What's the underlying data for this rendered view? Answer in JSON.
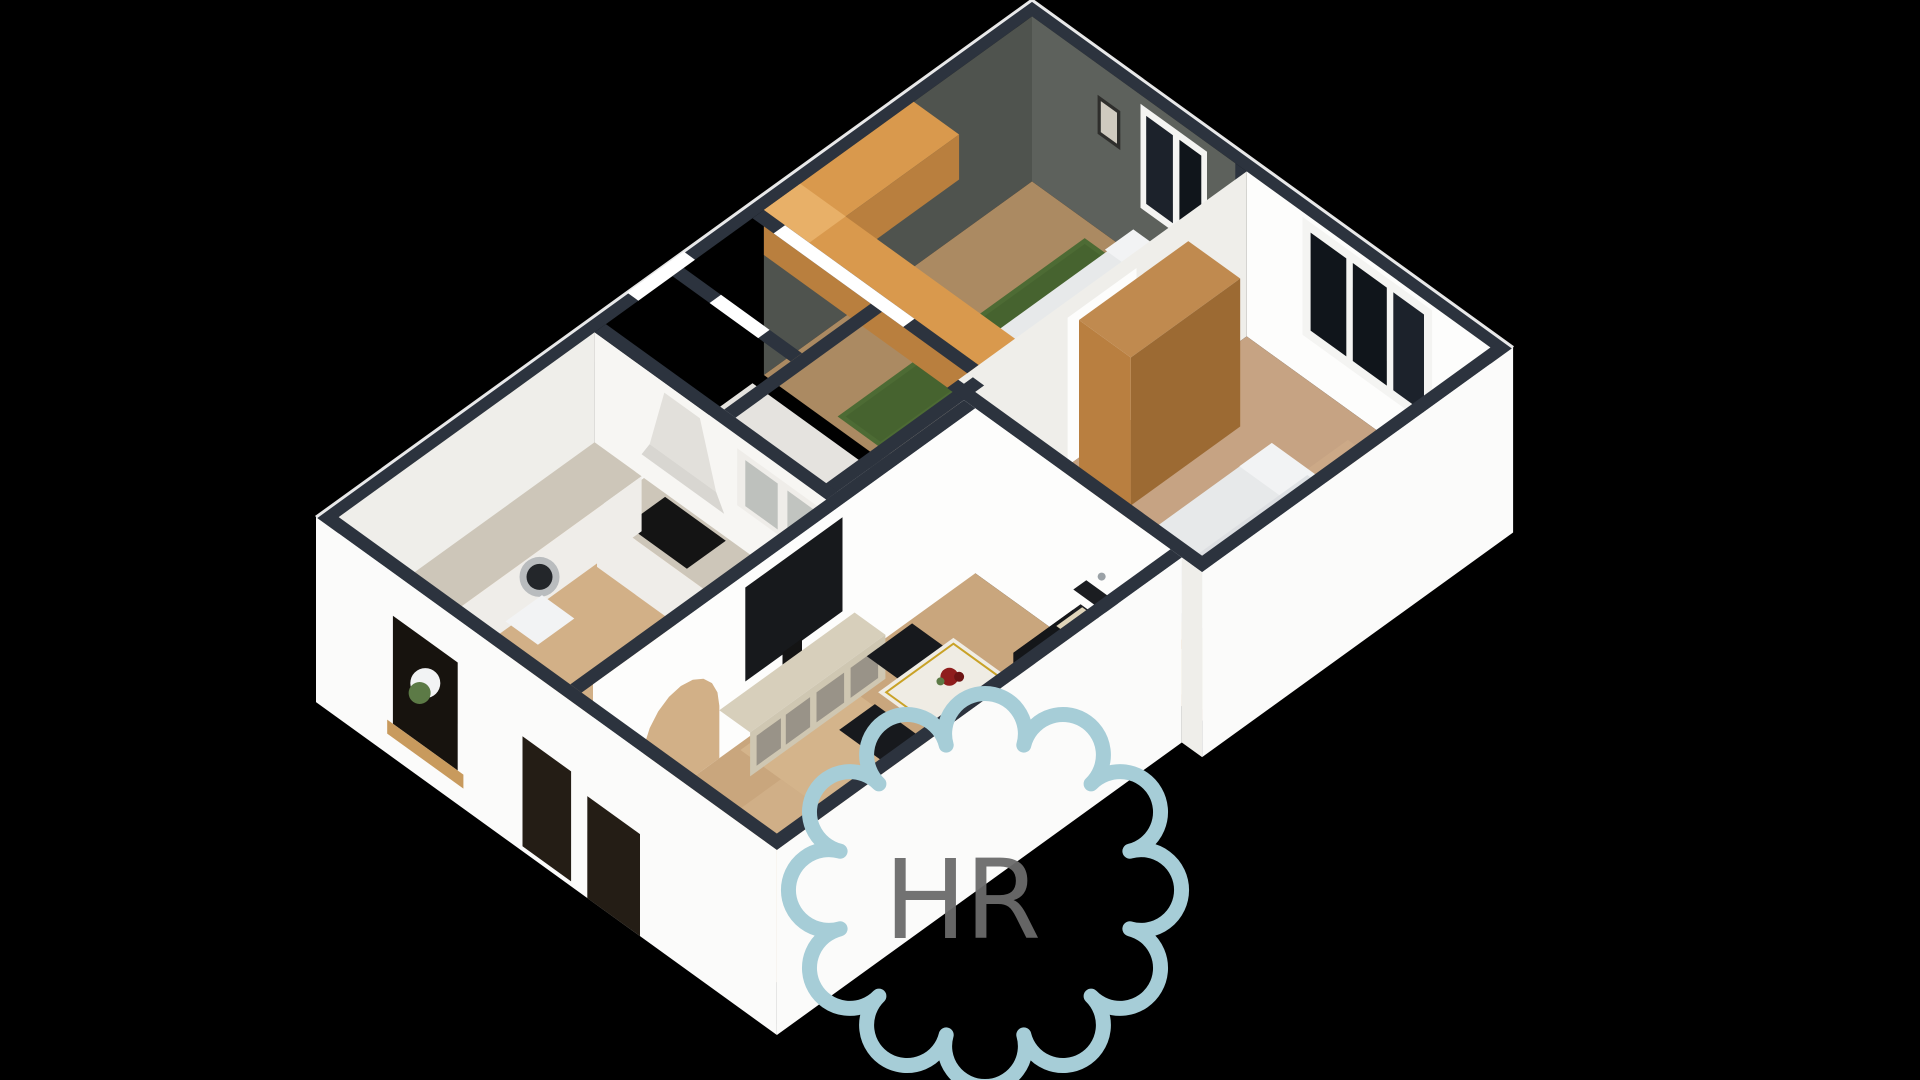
{
  "page": {
    "title": "3D isometric floor plan rendering",
    "background": "#000000"
  },
  "watermark": {
    "letters": "HR",
    "flower_color": "#a6cdd7",
    "letter_color": "#6a6a6a",
    "petal_count": 12
  },
  "palette": {
    "bg": "#000000",
    "wallTop": "#2c333e",
    "wallWhite": "#f7f6f3",
    "wallWhiteBright": "#fdfdfc",
    "wallShade": "#efeeea",
    "skirtWhite": "#fbfbfa",
    "darkWallA": "#4f534e",
    "darkWallB": "#5d615c",
    "floorDark": "#ab8a62",
    "floorDarkLight": "#b8945f",
    "floorBed1": "#c6a383",
    "floorBed1Light": "#d2b08c",
    "floorHall": "#e5e3df",
    "floorKitchen": "#d2b087",
    "floorLiving": "#c9a67d",
    "floorLivingLight": "#dcbf97",
    "woodBand": "#d9994d",
    "woodBandLight": "#e8b068",
    "woodBandSide": "#b97f3e",
    "wardrobe": "#c08a4f",
    "wardrobeFront": "#b97f40",
    "wardrobeSide": "#9c6a33",
    "greenRug": "#4d6b34",
    "greenRugDark": "#3f5c2a",
    "bedWhite": "#e7e9ea",
    "bedPillow": "#f2f3f4",
    "bedSide": "#c9cdd1",
    "bedDuvet": "#dadde0",
    "rugBeige": "#d8cba9",
    "benchWood": "#c6914f",
    "benchSide": "#aa7538",
    "counterMarble": "#cdc6b9",
    "cabinetWhite": "#efede9",
    "cabinetGlass": "#b5b9b5",
    "cooktop": "#141414",
    "hood": "#e2e0db",
    "hoodSkirt": "#d8d6d1",
    "washerRing": "#b9bcbe",
    "washerGlass": "#23262a",
    "sofaDark": "#1b1d21",
    "sofaFront": "#141619",
    "pillowCream": "#e0d5ba",
    "pillowCream2": "#d9cdb0",
    "tvBlack": "#17191c",
    "tvStand": "#d7cfbb",
    "tvStandFront": "#cfc7b2",
    "standGlass": "#8f8a80",
    "tableTop": "#efece4",
    "tableGold": "#c9a227",
    "flowerRed": "#8f1d1d",
    "flowerRedDark": "#6d1414",
    "flowerGreen": "#5c7a46",
    "chairDark": "#17191d",
    "paneBlack": "#10151b",
    "paneBlack2": "#1c222b",
    "paneWarm": "#241d15",
    "paneFlower": "#17130e",
    "sillWood": "#c89a5d",
    "sillWhite": "#ffffff",
    "frameWhite": "#f4f4f2",
    "pictureFrame": "#2e2e2c",
    "pictureInner": "#cfcabf",
    "handleGray": "#9aa1a6"
  },
  "scene": {
    "type": "isometric-3d-floor-plan",
    "view": "top-down oblique, rotated diamond orientation on black background",
    "rooms": [
      {
        "name": "bedroom-top",
        "walls": "dark gray",
        "furniture": [
          "l-shaped wood wardrobe counter",
          "single bed with white linen",
          "green rug strip",
          "picture frame",
          "window with white frame"
        ]
      },
      {
        "name": "bedroom-right",
        "walls": "white",
        "furniture": [
          "tall wooden wardrobe",
          "double bed with white duvet",
          "wood bench tray",
          "beige rug",
          "three-pane black window"
        ]
      },
      {
        "name": "hallway-bathroom",
        "walls": "white",
        "furniture": [
          "bright door sills",
          "small partition rooms"
        ]
      },
      {
        "name": "kitchen",
        "walls": "white",
        "furniture": [
          "range hood",
          "black cooktop",
          "marble counters",
          "glass upper cabinets",
          "washing machine",
          "window with flower vase on wood sill"
        ]
      },
      {
        "name": "living-room",
        "walls": "white",
        "furniture": [
          "flat tv on wall",
          "light wood tv console with glass doors",
          "arched doorway",
          "black sofa with cream pillows",
          "white dining table with gold legs and red flowers",
          "dark chairs",
          "two windows in outer wall"
        ]
      }
    ]
  }
}
